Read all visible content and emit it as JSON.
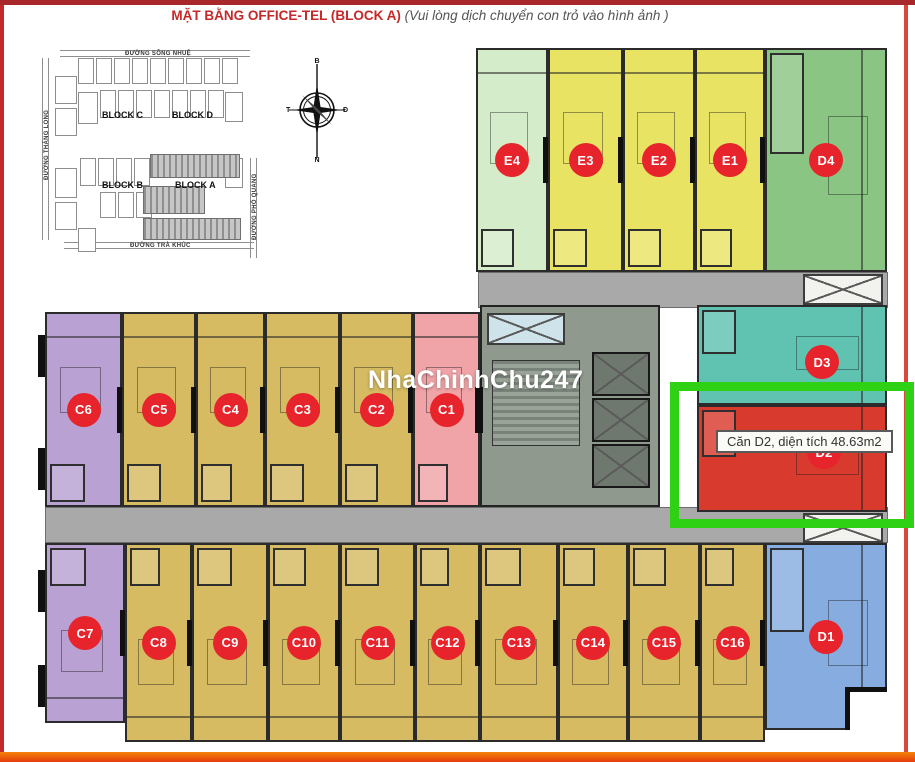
{
  "page": {
    "title": "MẶT BẰNG OFFICE-TEL (BLOCK A)",
    "subtitle": "(Vui lòng dịch chuyển con trỏ vào hình ảnh )",
    "watermark": "NhaChinhChu247"
  },
  "tooltip": {
    "text": "Căn D2, diện tích 48.63m2",
    "x": 716,
    "y": 430
  },
  "highlighted_unit": "D2",
  "overlay": {
    "highlight_box": {
      "x": 670,
      "y": 382,
      "w": 244,
      "h": 146
    }
  },
  "colors": {
    "lemon": "#e9e364",
    "paleGreen": "#d5ecca",
    "green": "#8bc584",
    "gold": "#d6bb62",
    "purple": "#b9a1d3",
    "pink": "#f0a4a7",
    "blue": "#87ace0",
    "teal": "#60c3b2",
    "red": "#d93a2e",
    "corridor": "#a9a9a9",
    "core": "#90998e",
    "lift": "#6e786f",
    "circle": "#e7232b",
    "highlight": "#2fd115",
    "wall": "#2b2b2b",
    "title_red": "#c52828"
  },
  "units": [
    {
      "label": "E4",
      "color": "paleGreen",
      "x": 476,
      "y": 48,
      "w": 72,
      "h": 224,
      "side": "bottom"
    },
    {
      "label": "E3",
      "color": "lemon",
      "x": 548,
      "y": 48,
      "w": 75,
      "h": 224,
      "side": "bottom"
    },
    {
      "label": "E2",
      "color": "lemon",
      "x": 623,
      "y": 48,
      "w": 72,
      "h": 224,
      "side": "bottom"
    },
    {
      "label": "E1",
      "color": "lemon",
      "x": 695,
      "y": 48,
      "w": 70,
      "h": 224,
      "side": "bottom"
    },
    {
      "label": "D4",
      "color": "green",
      "x": 765,
      "y": 48,
      "w": 122,
      "h": 224,
      "side": "left"
    },
    {
      "label": "C6",
      "color": "purple",
      "x": 45,
      "y": 312,
      "w": 77,
      "h": 195,
      "side": "bottom"
    },
    {
      "label": "C5",
      "color": "gold",
      "x": 122,
      "y": 312,
      "w": 74,
      "h": 195,
      "side": "bottom"
    },
    {
      "label": "C4",
      "color": "gold",
      "x": 196,
      "y": 312,
      "w": 69,
      "h": 195,
      "side": "bottom"
    },
    {
      "label": "C3",
      "color": "gold",
      "x": 265,
      "y": 312,
      "w": 75,
      "h": 195,
      "side": "bottom"
    },
    {
      "label": "C2",
      "color": "gold",
      "x": 340,
      "y": 312,
      "w": 73,
      "h": 195,
      "side": "bottom"
    },
    {
      "label": "C1",
      "color": "pink",
      "x": 413,
      "y": 312,
      "w": 67,
      "h": 195,
      "side": "bottom"
    },
    {
      "label": "D3",
      "color": "teal",
      "x": 697,
      "y": 305,
      "w": 190,
      "h": 100,
      "side": "left",
      "cx": 822,
      "cy": 362
    },
    {
      "label": "D2",
      "color": "red",
      "x": 697,
      "y": 405,
      "w": 190,
      "h": 107,
      "side": "left",
      "cx": 824,
      "cy": 452
    },
    {
      "label": "C7",
      "color": "purple",
      "x": 45,
      "y": 543,
      "w": 80,
      "h": 180,
      "side": "top"
    },
    {
      "label": "C8",
      "color": "gold",
      "x": 125,
      "y": 543,
      "w": 67,
      "h": 199,
      "side": "top"
    },
    {
      "label": "C9",
      "color": "gold",
      "x": 192,
      "y": 543,
      "w": 76,
      "h": 199,
      "side": "top"
    },
    {
      "label": "C10",
      "color": "gold",
      "x": 268,
      "y": 543,
      "w": 72,
      "h": 199,
      "side": "top"
    },
    {
      "label": "C11",
      "color": "gold",
      "x": 340,
      "y": 543,
      "w": 75,
      "h": 199,
      "side": "top"
    },
    {
      "label": "C12",
      "color": "gold",
      "x": 415,
      "y": 543,
      "w": 65,
      "h": 199,
      "side": "top"
    },
    {
      "label": "C13",
      "color": "gold",
      "x": 480,
      "y": 543,
      "w": 78,
      "h": 199,
      "side": "top"
    },
    {
      "label": "C14",
      "color": "gold",
      "x": 558,
      "y": 543,
      "w": 70,
      "h": 199,
      "side": "top"
    },
    {
      "label": "C15",
      "color": "gold",
      "x": 628,
      "y": 543,
      "w": 72,
      "h": 199,
      "side": "top"
    },
    {
      "label": "C16",
      "color": "gold",
      "x": 700,
      "y": 543,
      "w": 65,
      "h": 199,
      "side": "top"
    },
    {
      "label": "D1",
      "color": "blue",
      "x": 765,
      "y": 543,
      "w": 122,
      "h": 187,
      "side": "left"
    }
  ],
  "zones": {
    "corridors": [
      {
        "x": 478,
        "y": 272,
        "w": 410,
        "h": 36
      },
      {
        "x": 45,
        "y": 507,
        "w": 843,
        "h": 36
      }
    ],
    "core": {
      "x": 480,
      "y": 305,
      "w": 180,
      "h": 202
    },
    "stairs": {
      "x": 492,
      "y": 360,
      "w": 88,
      "h": 86
    },
    "elevators": [
      {
        "x": 592,
        "y": 352,
        "w": 58,
        "h": 44
      },
      {
        "x": 592,
        "y": 398,
        "w": 58,
        "h": 44
      },
      {
        "x": 592,
        "y": 444,
        "w": 58,
        "h": 44
      }
    ],
    "hatches": [
      {
        "x": 487,
        "y": 313,
        "w": 78,
        "h": 32,
        "style": "blue"
      },
      {
        "x": 803,
        "y": 274,
        "w": 80,
        "h": 31,
        "style": "light"
      },
      {
        "x": 803,
        "y": 513,
        "w": 80,
        "h": 30,
        "style": "light"
      }
    ],
    "wall_tabs": [
      {
        "x": 38,
        "y": 335,
        "w": 10,
        "h": 42
      },
      {
        "x": 38,
        "y": 448,
        "w": 10,
        "h": 42
      },
      {
        "x": 38,
        "y": 570,
        "w": 10,
        "h": 42
      },
      {
        "x": 38,
        "y": 665,
        "w": 10,
        "h": 42
      }
    ],
    "d1_notch": {
      "x": 845,
      "y": 687,
      "w": 42,
      "h": 43
    }
  },
  "minimap": {
    "streets": {
      "top": "ĐƯỜNG SÔNG NHUỆ",
      "bottom": "ĐƯỜNG TRÀ KHÚC",
      "left": "ĐƯỜNG THĂNG LONG",
      "right": "ĐƯỜNG PHỔ QUANG"
    },
    "blocks": [
      {
        "label": "BLOCK C",
        "x": 72,
        "y": 70
      },
      {
        "label": "BLOCK D",
        "x": 142,
        "y": 70
      },
      {
        "label": "BLOCK B",
        "x": 72,
        "y": 140
      },
      {
        "label": "BLOCK A",
        "x": 145,
        "y": 140
      }
    ],
    "compass": {
      "n": "B",
      "e": "Đ",
      "s": "N",
      "w": "T"
    },
    "unit_rows": [
      {
        "x": 48,
        "y": 18,
        "count": 9,
        "w": 16,
        "h": 26,
        "gap": 2
      },
      {
        "x": 70,
        "y": 50,
        "count": 7,
        "w": 16,
        "h": 28,
        "gap": 2
      },
      {
        "x": 50,
        "y": 118,
        "count": 4,
        "w": 16,
        "h": 28,
        "gap": 2
      },
      {
        "x": 70,
        "y": 152,
        "count": 3,
        "w": 16,
        "h": 26,
        "gap": 2
      }
    ],
    "big_rects": [
      {
        "x": 25,
        "y": 36,
        "w": 22,
        "h": 28
      },
      {
        "x": 25,
        "y": 68,
        "w": 22,
        "h": 28
      },
      {
        "x": 48,
        "y": 52,
        "w": 20,
        "h": 32
      },
      {
        "x": 25,
        "y": 128,
        "w": 22,
        "h": 30
      },
      {
        "x": 25,
        "y": 162,
        "w": 22,
        "h": 28
      },
      {
        "x": 48,
        "y": 188,
        "w": 18,
        "h": 24
      },
      {
        "x": 195,
        "y": 52,
        "w": 18,
        "h": 30
      },
      {
        "x": 195,
        "y": 118,
        "w": 18,
        "h": 30
      }
    ],
    "hatch_rects": [
      {
        "x": 120,
        "y": 114,
        "w": 90,
        "h": 24
      },
      {
        "x": 113,
        "y": 146,
        "w": 62,
        "h": 28
      },
      {
        "x": 113,
        "y": 178,
        "w": 98,
        "h": 22
      }
    ]
  }
}
